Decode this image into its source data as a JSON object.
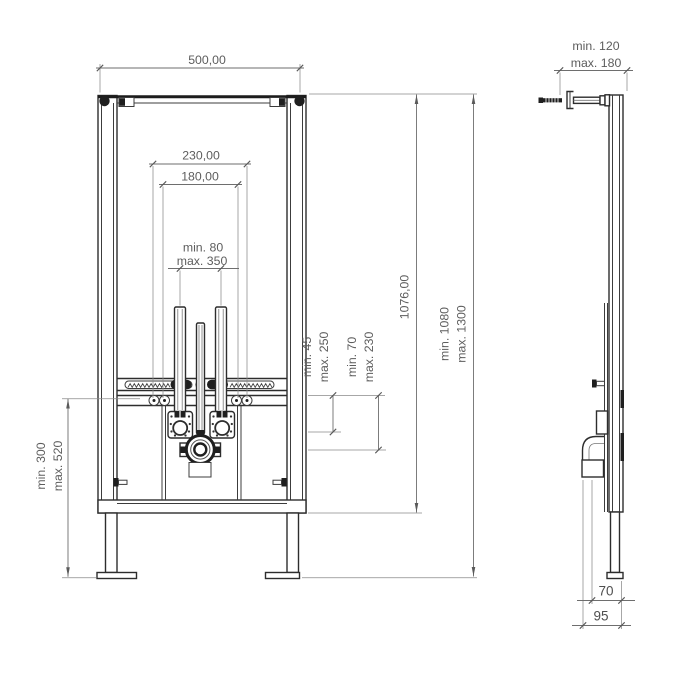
{
  "front_view": {
    "width_label": "500,00",
    "outer_spacing_label": "230,00",
    "inner_spacing_label": "180,00",
    "drain_range_min": "min. 80",
    "drain_range_max": "max. 350",
    "frame_height_label": "1076,00",
    "install_height_min": "min. 1080",
    "install_height_max": "max. 1300",
    "bar_offset_min": "min. 45",
    "bar_offset_max": "max. 250",
    "drain_offset_min": "min. 70",
    "drain_offset_max": "max. 230",
    "floor_range_min": "min. 300",
    "floor_range_max": "max. 520"
  },
  "side_view": {
    "rod_depth_min": "min. 120",
    "rod_depth_max": "max. 180",
    "pipe_offset_label": "70",
    "frame_depth_label": "95"
  },
  "colors": {
    "background": "#ffffff",
    "structure_line": "#2d2d2d",
    "dimension_line": "#6e6e6e",
    "label_text": "#5d5d5d"
  }
}
